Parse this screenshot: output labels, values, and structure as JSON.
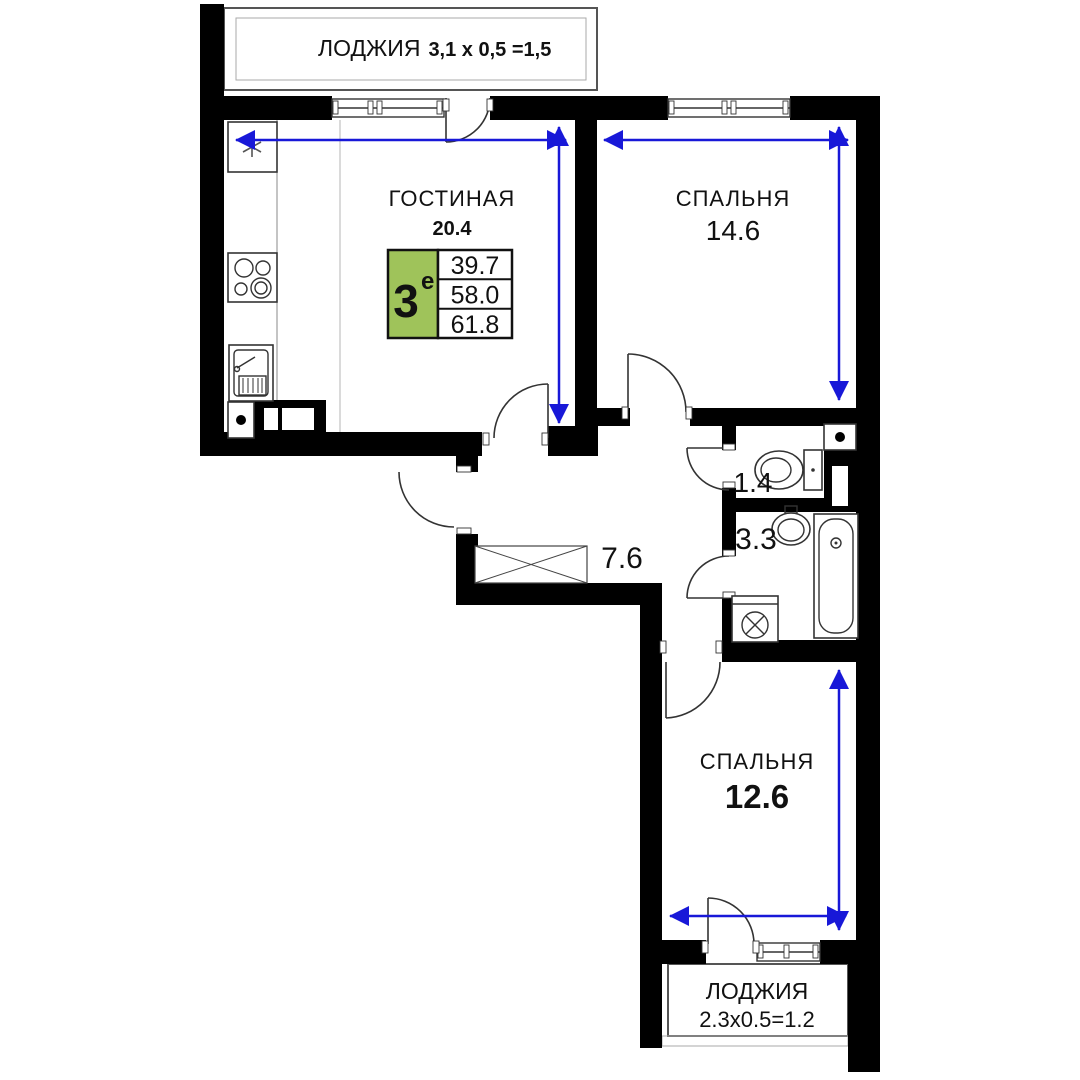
{
  "plan": {
    "title": "apartment-floor-plan",
    "rooms": [
      {
        "id": "loggia-top",
        "name": "ЛОДЖИЯ",
        "dims": "3,1 х 0,5 =1,5"
      },
      {
        "id": "living-room",
        "name": "ГОСТИНАЯ",
        "area": "20.4"
      },
      {
        "id": "bedroom-1",
        "name": "СПАЛЬНЯ",
        "area": "14.6"
      },
      {
        "id": "wc",
        "area": "1.4"
      },
      {
        "id": "bathroom",
        "area": "3.3"
      },
      {
        "id": "hall",
        "area": "7.6"
      },
      {
        "id": "bedroom-2",
        "name": "СПАЛЬНЯ",
        "area": "12.6"
      },
      {
        "id": "loggia-bottom",
        "name": "ЛОДЖИЯ",
        "dims": "2.3х0.5=1.2"
      }
    ],
    "badge": {
      "floor_number": "3",
      "floor_sup": "е",
      "areas": [
        "39.7",
        "58.0",
        "61.8"
      ],
      "color": "#9fc35a"
    },
    "colors": {
      "walls": "#000000",
      "dimension_arrows": "#1818d8",
      "fixtures": "#333333"
    }
  }
}
